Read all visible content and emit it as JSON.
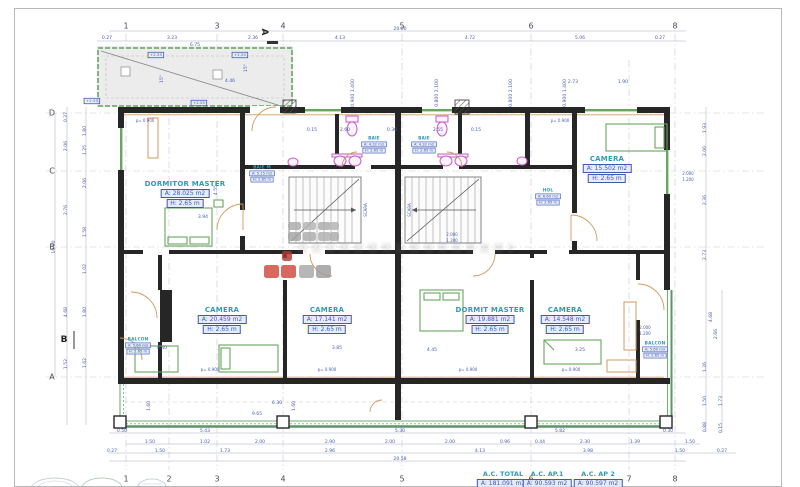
{
  "drawing": {
    "grid": {
      "top_numbers": [
        {
          "t": "1",
          "x": 126
        },
        {
          "t": "3",
          "x": 217
        },
        {
          "t": "4",
          "x": 283
        },
        {
          "t": "5",
          "x": 402
        },
        {
          "t": "6",
          "x": 531
        },
        {
          "t": "8",
          "x": 675
        }
      ],
      "bottom_numbers": [
        {
          "t": "1",
          "x": 126
        },
        {
          "t": "2",
          "x": 169
        },
        {
          "t": "3",
          "x": 217
        },
        {
          "t": "4",
          "x": 283
        },
        {
          "t": "5",
          "x": 402
        },
        {
          "t": "6",
          "x": 531
        },
        {
          "t": "7",
          "x": 629
        },
        {
          "t": "8",
          "x": 675
        }
      ],
      "left_letters": [
        {
          "t": "D",
          "y": 113
        },
        {
          "t": "C",
          "y": 171
        },
        {
          "t": "B",
          "y": 247
        },
        {
          "t": "A",
          "y": 377
        }
      ],
      "section_markers": [
        {
          "t": "A",
          "x": 264,
          "y": 32,
          "rot": true
        },
        {
          "t": "B",
          "x": 64,
          "y": 340,
          "rot": false
        }
      ]
    },
    "rooms": [
      {
        "name": "DORMITOR MASTER",
        "area": "A: 28.025 m2",
        "height": "H: 2.65 m",
        "x": 185,
        "y": 180
      },
      {
        "name": "CAMERA",
        "area": "A: 15.502 m2",
        "height": "H: 2.65 m",
        "x": 607,
        "y": 155
      },
      {
        "name": "CAMERA",
        "area": "A: 20.459 m2",
        "height": "H: 2.65 m",
        "x": 222,
        "y": 306
      },
      {
        "name": "CAMERA",
        "area": "A: 17.141 m2",
        "height": "H: 2.65 m",
        "x": 327,
        "y": 306
      },
      {
        "name": "DORMIT MASTER",
        "area": "A: 19.881 m2",
        "height": "H: 2.65 m",
        "x": 490,
        "y": 306
      },
      {
        "name": "CAMERA",
        "area": "A: 14.548 m2",
        "height": "H: 2.65 m",
        "x": 565,
        "y": 306
      }
    ],
    "small_rooms": [
      {
        "name": "BAIE",
        "area": "A: 4.32 m2",
        "height": "H: 2.65 m",
        "x": 374,
        "y": 136
      },
      {
        "name": "BAIE",
        "area": "A: 4.32 m2",
        "height": "H: 2.65 m",
        "x": 424,
        "y": 136
      },
      {
        "name": "BAIE M",
        "area": "A: 5.15 m2",
        "height": "H: 2.65 m",
        "x": 262,
        "y": 165
      },
      {
        "name": "HOL",
        "area": "A: 6.60 m2",
        "height": "H: 2.65 m",
        "x": 548,
        "y": 188
      },
      {
        "name": "BALCON",
        "area": "A: 5.60 m2",
        "height": "H: 2.65 m",
        "x": 138,
        "y": 337
      },
      {
        "name": "BALCON",
        "area": "A: 5.60 m2",
        "height": "H: 2.65 m",
        "x": 655,
        "y": 341
      }
    ],
    "totals": [
      {
        "title": "A.C. TOTAL",
        "value": "A: 181.091 m2",
        "x": 503
      },
      {
        "title": "A.C. AP.1",
        "value": "A: 90.593 m2",
        "x": 547
      },
      {
        "title": "A.C. AP 2",
        "value": "A: 90.597 m2",
        "x": 598
      }
    ],
    "levels": [
      {
        "t": "+2.55",
        "x": 156,
        "y": 55
      },
      {
        "t": "+2.55",
        "x": 240,
        "y": 55
      },
      {
        "t": "+2.55",
        "x": 92,
        "y": 101
      },
      {
        "t": "+2.55",
        "x": 199,
        "y": 103
      }
    ],
    "dims": [
      [
        "0.27",
        107,
        39,
        0
      ],
      [
        "3.23",
        172,
        39,
        0
      ],
      [
        "2.36",
        253,
        39,
        0
      ],
      [
        "4.13",
        340,
        39,
        0
      ],
      [
        "4.72",
        470,
        39,
        0
      ],
      [
        "5.06",
        580,
        39,
        0
      ],
      [
        "0.27",
        660,
        39,
        0
      ],
      [
        "6.75",
        195,
        46,
        0
      ],
      [
        "20.00",
        400,
        30,
        0
      ],
      [
        "4.46",
        230,
        82,
        0
      ],
      [
        "2.73",
        573,
        83,
        0
      ],
      [
        "1.90",
        623,
        83,
        0
      ],
      [
        "15°",
        163,
        79,
        1
      ],
      [
        "15°",
        247,
        68,
        1
      ],
      [
        "0.900 1.400",
        354,
        93,
        1
      ],
      [
        "0.800 2.100",
        438,
        93,
        1
      ],
      [
        "0.800 2.100",
        512,
        93,
        1
      ],
      [
        "0.900 1.400",
        566,
        93,
        1
      ],
      [
        "0.15",
        312,
        131,
        0
      ],
      [
        "2.60",
        345,
        131,
        0
      ],
      [
        "0.30",
        392,
        131,
        0
      ],
      [
        "2.55",
        438,
        131,
        0
      ],
      [
        "0.15",
        476,
        131,
        0
      ],
      [
        "3.94",
        203,
        218,
        0
      ],
      [
        "4.55",
        217,
        190,
        1
      ],
      [
        "8.40",
        162,
        349,
        0
      ],
      [
        "3.85",
        337,
        349,
        0
      ],
      [
        "4.45",
        432,
        351,
        0
      ],
      [
        "3.25",
        580,
        351,
        0
      ],
      [
        "6.30",
        277,
        404,
        0
      ],
      [
        "9.65",
        257,
        415,
        0
      ],
      [
        "1.60",
        150,
        406,
        1
      ],
      [
        "1.60",
        295,
        406,
        1
      ],
      [
        "10.00",
        55,
        247,
        1
      ],
      [
        "0.27",
        67,
        117,
        1
      ],
      [
        "2.06",
        67,
        146,
        1
      ],
      [
        "2.76",
        67,
        210,
        1
      ],
      [
        "4.68",
        67,
        312,
        1
      ],
      [
        "1.52",
        67,
        364,
        1
      ],
      [
        "1.80",
        86,
        131,
        1
      ],
      [
        "1.25",
        86,
        150,
        1
      ],
      [
        "2.06",
        86,
        183,
        1
      ],
      [
        "1.58",
        86,
        232,
        1
      ],
      [
        "1.02",
        86,
        269,
        1
      ],
      [
        "1.80",
        86,
        312,
        1
      ],
      [
        "1.62",
        86,
        363,
        1
      ],
      [
        "1.93",
        706,
        128,
        1
      ],
      [
        "2.06",
        706,
        151,
        1
      ],
      [
        "2.36",
        706,
        200,
        1
      ],
      [
        "2.73",
        706,
        255,
        1
      ],
      [
        "4.68",
        712,
        317,
        1
      ],
      [
        "2.66",
        717,
        334,
        1
      ],
      [
        "1.26",
        706,
        367,
        1
      ],
      [
        "1.50",
        706,
        401,
        1
      ],
      [
        "0.88",
        706,
        427,
        1
      ],
      [
        "1.73",
        722,
        401,
        1
      ],
      [
        "0.15",
        722,
        428,
        1
      ],
      [
        "0.50",
        122,
        432,
        0
      ],
      [
        "5.43",
        205,
        432,
        0
      ],
      [
        "5.30",
        400,
        432,
        0
      ],
      [
        "5.82",
        560,
        432,
        0
      ],
      [
        "0.30",
        668,
        432,
        0
      ],
      [
        "1.50",
        150,
        443,
        0
      ],
      [
        "1.02",
        205,
        443,
        0
      ],
      [
        "2.00",
        260,
        443,
        0
      ],
      [
        "2.90",
        330,
        443,
        0
      ],
      [
        "2.00",
        390,
        443,
        0
      ],
      [
        "2.00",
        450,
        443,
        0
      ],
      [
        "0.96",
        505,
        443,
        0
      ],
      [
        "0.44",
        540,
        443,
        0
      ],
      [
        "2.30",
        585,
        443,
        0
      ],
      [
        "1.39",
        635,
        443,
        0
      ],
      [
        "1.50",
        690,
        443,
        0
      ],
      [
        "0.27",
        112,
        452,
        0
      ],
      [
        "1.50",
        160,
        452,
        0
      ],
      [
        "1.73",
        225,
        452,
        0
      ],
      [
        "2.96",
        330,
        452,
        0
      ],
      [
        "4.13",
        480,
        452,
        0
      ],
      [
        "3.98",
        588,
        452,
        0
      ],
      [
        "1.50",
        680,
        452,
        0
      ],
      [
        "0.27",
        722,
        452,
        0
      ],
      [
        "20.58",
        400,
        460,
        0
      ]
    ],
    "notes": [
      [
        "p= 0.900",
        145,
        122,
        0
      ],
      [
        "p= 0.900",
        560,
        122,
        0
      ],
      [
        "p= 0.900",
        210,
        371,
        0
      ],
      [
        "p= 0.900",
        327,
        371,
        0
      ],
      [
        "p= 0.900",
        468,
        371,
        0
      ],
      [
        "p= 0.900",
        571,
        371,
        0
      ],
      [
        "2.000",
        688,
        175,
        0
      ],
      [
        "1.200",
        688,
        181,
        0
      ],
      [
        "2.000",
        645,
        329,
        0
      ],
      [
        "1.200",
        645,
        335,
        0
      ],
      [
        "2.000",
        452,
        236,
        0
      ],
      [
        "1.200",
        452,
        242,
        0
      ],
      [
        "SCARA",
        367,
        210,
        1
      ],
      [
        "SCARA",
        411,
        210,
        1
      ]
    ],
    "watermark": {
      "squares": [
        [
          288,
          222,
          13,
          8,
          "#ababab"
        ],
        [
          303,
          222,
          13,
          8,
          "#b4b4b4"
        ],
        [
          318,
          222,
          13,
          8,
          "#ababab"
        ],
        [
          330,
          222,
          9,
          8,
          "#b4b4b4"
        ],
        [
          288,
          232,
          13,
          9,
          "#a4a4a4"
        ],
        [
          303,
          232,
          13,
          9,
          "#ababab"
        ],
        [
          318,
          232,
          13,
          9,
          "#b0b0b0"
        ],
        [
          330,
          232,
          9,
          9,
          "#ababab"
        ],
        [
          282,
          251,
          10,
          10,
          "#b03a30"
        ],
        [
          264,
          265,
          15,
          13,
          "#d0493d"
        ],
        [
          281,
          265,
          15,
          13,
          "#d0493d"
        ],
        [
          299,
          265,
          15,
          13,
          "#a8a8a8"
        ],
        [
          316,
          265,
          15,
          13,
          "#9c9c9c"
        ]
      ]
    },
    "colors": {
      "dim_blue": "#4a5db0",
      "label_teal": "#2e9bb5",
      "box_blue": "#4059b3",
      "wall": "#262626",
      "green": "#69a55f",
      "magenta": "#c55bc5",
      "tan": "#cf9a62",
      "paper": "#ffffff",
      "terrace": "#ececec",
      "watermark_red": "#d0493d",
      "watermark_gray": "#a8a8a8"
    }
  }
}
